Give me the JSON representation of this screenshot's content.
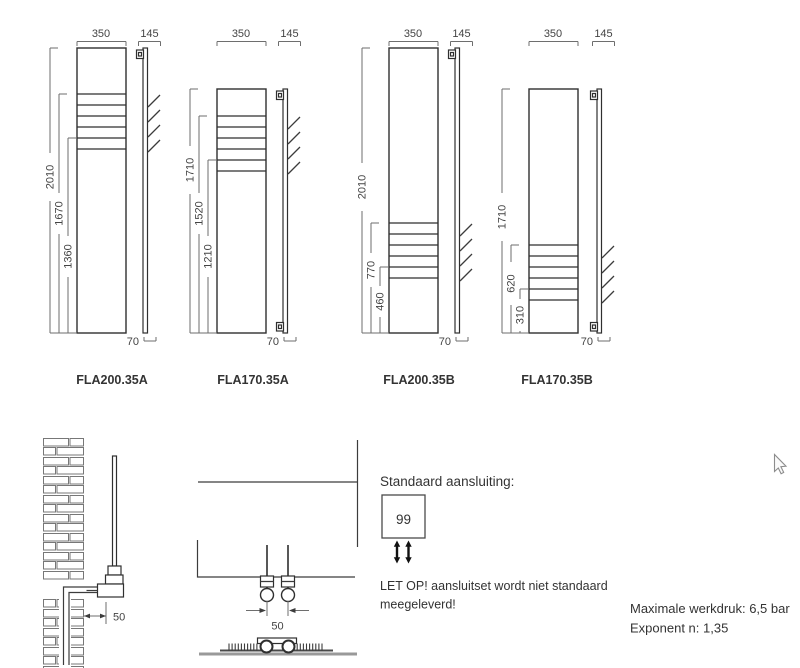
{
  "figures": [
    {
      "model": "FLA200.35A",
      "width": "350",
      "depth": "145",
      "height": "2010",
      "slot_top": "1670",
      "slot_bottom": "1360",
      "panel_depth": "70"
    },
    {
      "model": "FLA170.35A",
      "width": "350",
      "depth": "145",
      "height": "1710",
      "slot_top": "1520",
      "slot_bottom": "1210",
      "panel_depth": "70"
    },
    {
      "model": "FLA200.35B",
      "width": "350",
      "depth": "145",
      "height": "2010",
      "slot_top": "770",
      "slot_bottom": "460",
      "panel_depth": "70"
    },
    {
      "model": "FLA170.35B",
      "width": "350",
      "depth": "145",
      "height": "1710",
      "slot_top": "620",
      "slot_bottom": "310",
      "panel_depth": "70"
    }
  ],
  "installation_details": {
    "wall_distance": "50",
    "pipe_spacing": "50"
  },
  "connection_info": {
    "heading": "Standaard aansluiting:",
    "code": "99",
    "warning_line1": "LET OP! aansluitset wordt niet standaard",
    "warning_line2": "meegeleverd!"
  },
  "specifications": {
    "max_pressure": "Maximale werkdruk: 6,5 bar",
    "exponent": "Exponent n: 1,35"
  }
}
